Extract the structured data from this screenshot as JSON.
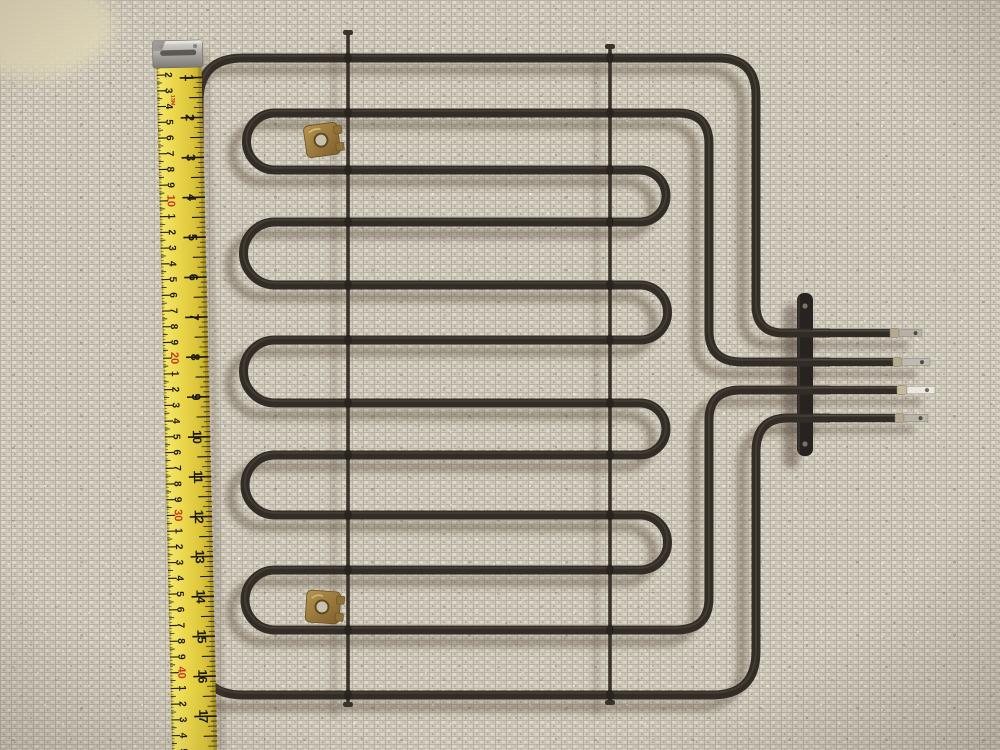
{
  "scene": {
    "description": "Photograph of a black serpentine oven broiler heating element with four spade terminals, lying on beige berber carpet, with a yellow tape measure along the left edge",
    "object_label": "oven-heating-element",
    "background_label": "beige-carpet"
  },
  "colors": {
    "carpet_base": "#d1cbbe",
    "tube": "#332d27",
    "brass_clip": "#9a7a42",
    "bracket_plate": "#282320",
    "tape_yellow": "#e9d44a",
    "tape_decade_red": "#c23a1e",
    "tape_digit_black": "#1b1812",
    "terminal_metal": "#c0bbb0"
  },
  "tape": {
    "spec_mark": "13M",
    "cm_labels": [
      "1",
      "2",
      "3",
      "4",
      "5",
      "6",
      "7",
      "8",
      "9",
      "10",
      "1",
      "2",
      "3",
      "4",
      "5",
      "6",
      "7",
      "8",
      "9",
      "20",
      "1",
      "2",
      "3",
      "4",
      "5",
      "6",
      "7",
      "8",
      "9",
      "30",
      "1",
      "2",
      "3",
      "4",
      "5",
      "6",
      "7",
      "8",
      "9",
      "40",
      "1",
      "2",
      "3",
      "4",
      "5"
    ],
    "inch_labels": [
      "1",
      "2",
      "3",
      "4",
      "5",
      "6",
      "7",
      "8",
      "9",
      "10",
      "11",
      "12",
      "13",
      "14",
      "15",
      "16",
      "17"
    ]
  },
  "geometry": {
    "tape": {
      "cm_y0": 59,
      "cm_step": 15.73,
      "inch_y0": 78,
      "inch_step": 39.92,
      "max_y": 752
    },
    "rod_xs": [
      348,
      610
    ],
    "crossings": [
      58,
      113,
      170,
      222,
      285,
      340,
      403,
      455,
      515,
      570,
      630,
      695
    ]
  },
  "element": {
    "terminal_count": 4,
    "serpentine_row_count": 10
  }
}
